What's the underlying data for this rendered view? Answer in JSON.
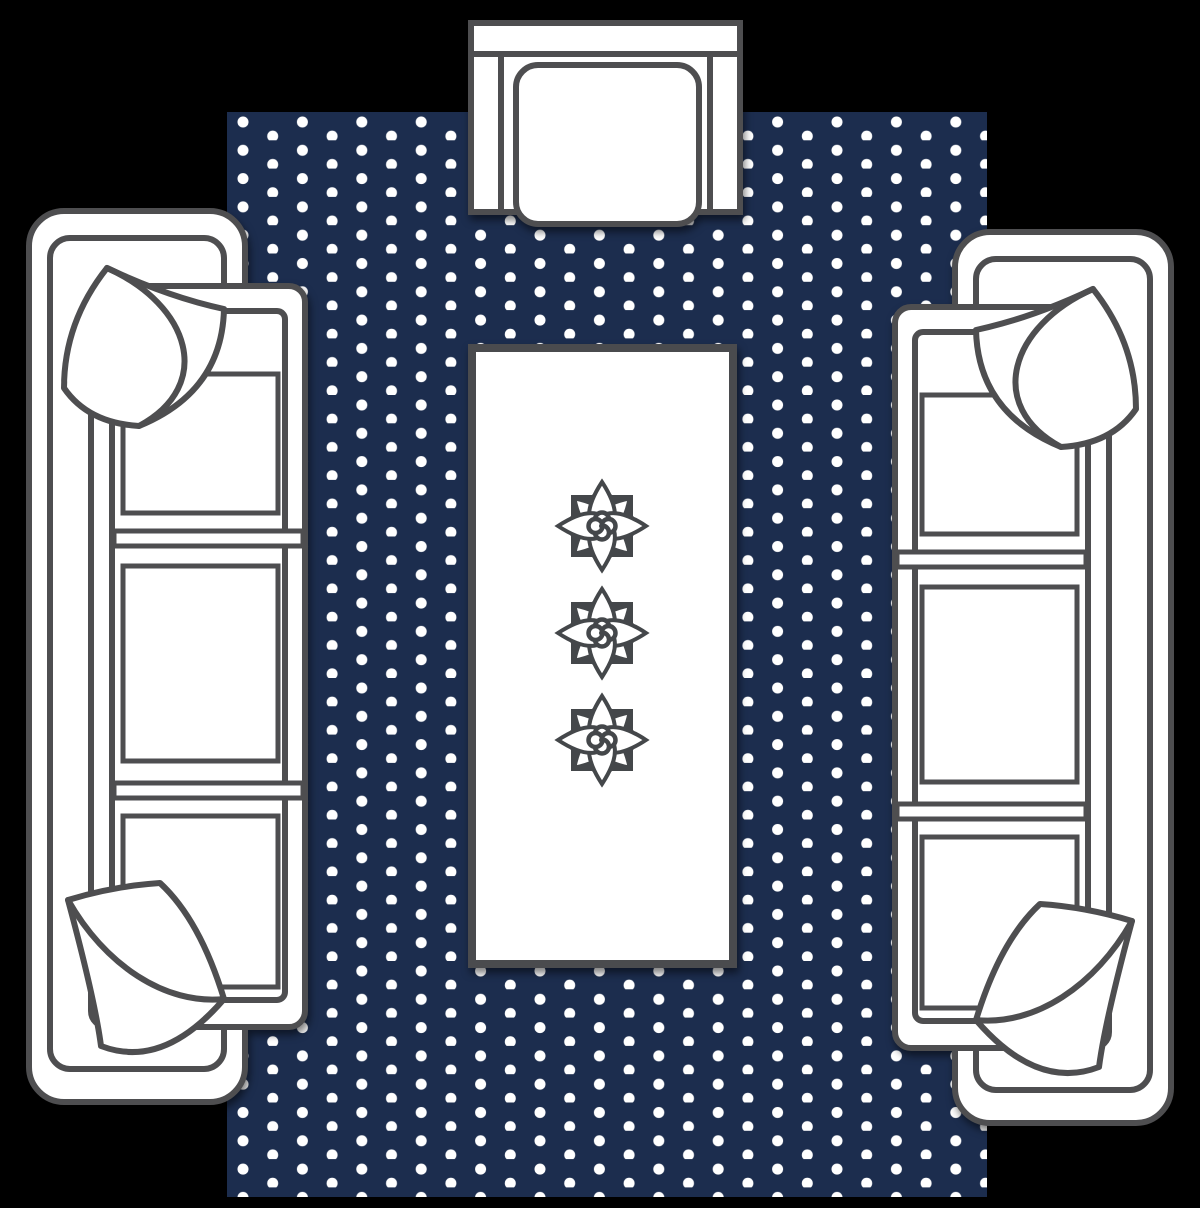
{
  "scene": {
    "type": "furniture-layout-diagram",
    "room": "living-room-seating-area",
    "view": "top-down-plan"
  },
  "colors": {
    "background": "#000000",
    "rug": "#1c2d4e",
    "dot": "#ffffff",
    "outline": "#4e4e50",
    "fill": "#ffffff",
    "ornament": "#44474a",
    "table_border": "#4a4b4e"
  },
  "rug": {
    "pattern": "polka-dot",
    "dot_radius": 5.5,
    "dot_column_spacing": 29.7,
    "dot_row_spacing": 28.3,
    "stagger_offset": 14.15
  },
  "items": [
    {
      "id": "rug",
      "label": "polka-dot-area-rug"
    },
    {
      "id": "armchair-top",
      "label": "armchair-with-seat-cushion"
    },
    {
      "id": "sofa-left",
      "label": "three-seat-sofa-with-two-throw-pillows"
    },
    {
      "id": "sofa-right",
      "label": "three-seat-sofa-with-two-throw-pillows"
    },
    {
      "id": "coffee-table",
      "label": "coffee-table-with-three-floral-ornaments"
    }
  ],
  "ornament_count": 3
}
